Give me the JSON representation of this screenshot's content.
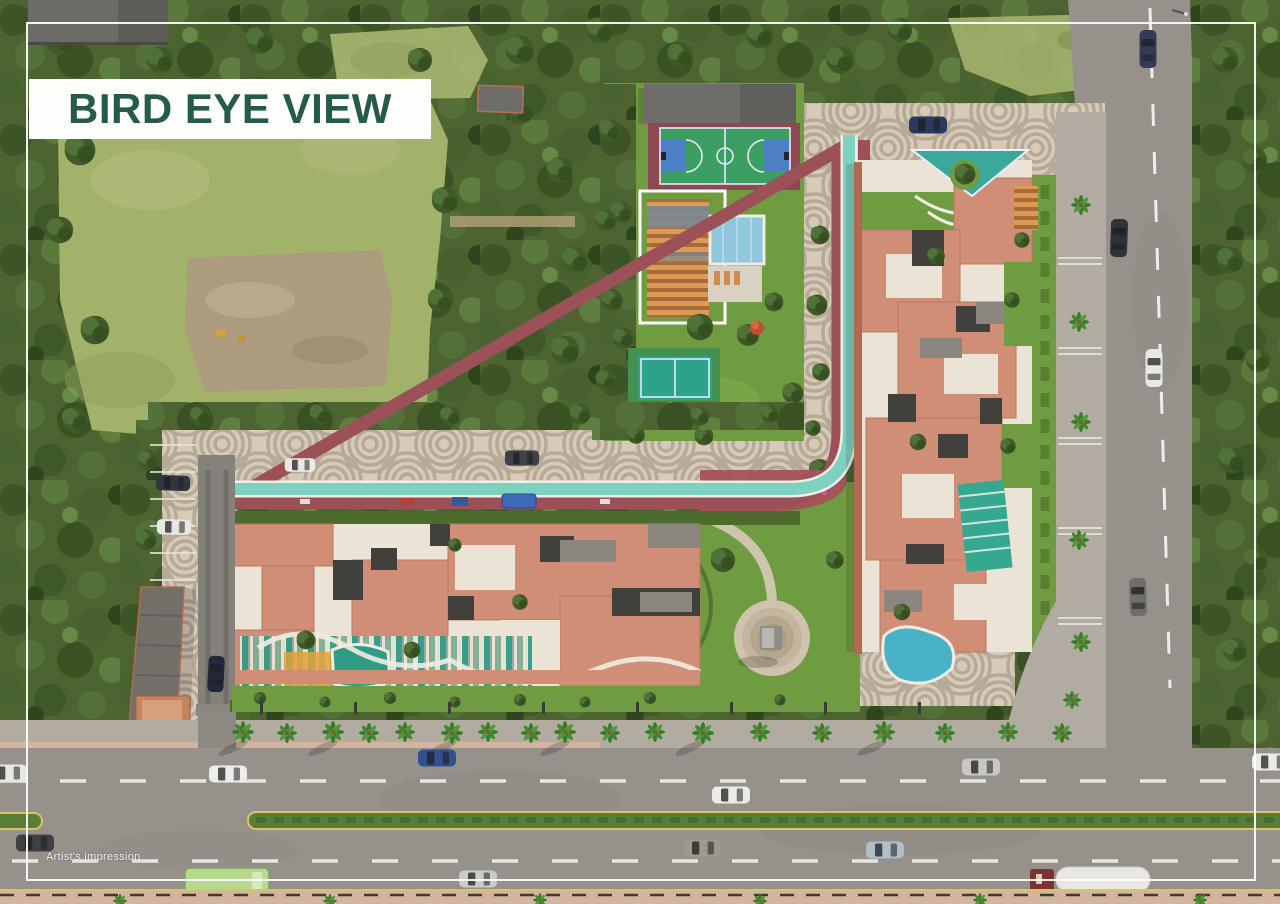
{
  "header": {
    "title": "BIRD EYE VIEW"
  },
  "footer": {
    "caption": "Artist's impression"
  },
  "palette": {
    "title_green": "#265c47",
    "trees_base": "#4d6430",
    "field": "#a3b26b",
    "dirt": "#ac9b7d",
    "asphalt": "#96918b",
    "sidewalk": "#b2aba2",
    "plaza": "#d7cbb8",
    "plaza_ring": "#a99e8e",
    "terracotta": "#d18e76",
    "terracotta_edge": "#b06a52",
    "cream": "#ebe3d5",
    "dark_roof": "#42403c",
    "gray_roof": "#8b8780",
    "track_teal": "#7ed0bf",
    "path_maroon": "#9c5158",
    "lawn": "#6f9c41",
    "hedge": "#4c6b2d",
    "pool_blue": "#8fc6dc",
    "court_green": "#3b9f63",
    "court_blue": "#4d7fc4",
    "court_maroon": "#8e4852",
    "wood_orange": "#cf8c4e",
    "curb_yellow": "#d9c36a",
    "pink_walk": "#d3b49f"
  }
}
